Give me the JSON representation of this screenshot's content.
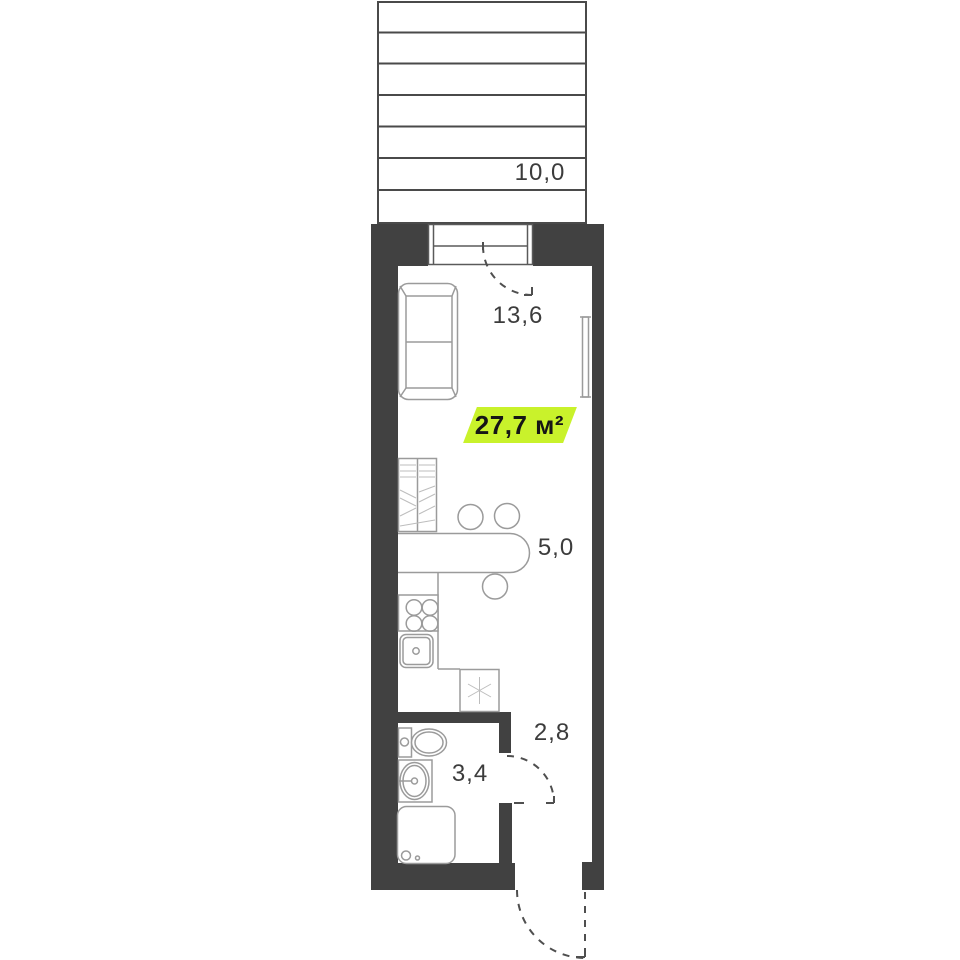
{
  "plan": {
    "area_badge": {
      "label": "27,7 м²"
    },
    "rooms": [
      {
        "name": "terrace",
        "area": "10,0"
      },
      {
        "name": "living-room",
        "area": "13,6"
      },
      {
        "name": "kitchen",
        "area": "5,0"
      },
      {
        "name": "hallway",
        "area": "2,8"
      },
      {
        "name": "bathroom",
        "area": "3,4"
      }
    ],
    "icons": {
      "appliance_symbol": "six-spoke-asterisk"
    },
    "colors": {
      "wall": "#414141",
      "outline": "#4a4a4a",
      "furniture": "#9b9b9b",
      "label": "#3c3c3c",
      "badge": "#c9f22b",
      "badge_text": "#161616"
    }
  }
}
